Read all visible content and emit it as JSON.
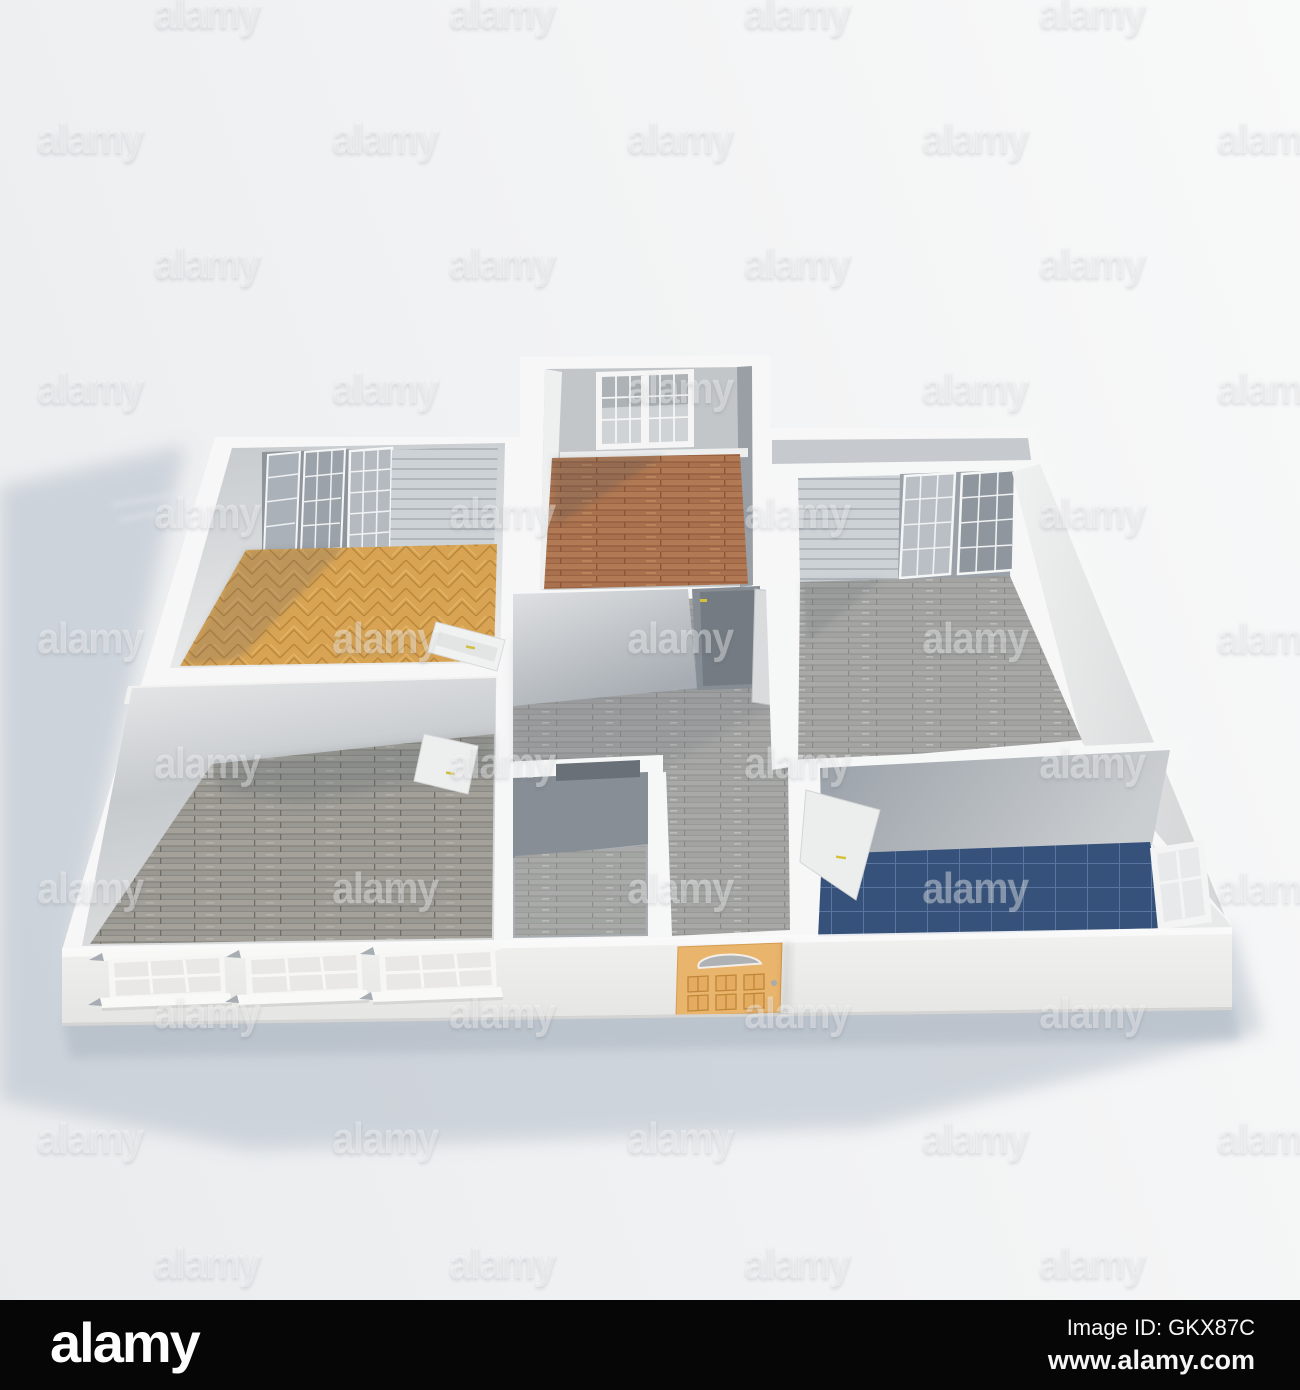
{
  "watermark": {
    "text": "alamy",
    "row_start_y": 15,
    "row_spacing": 125,
    "row_count": 11,
    "col_spacing": 295,
    "row_offsets": [
      207,
      90
    ],
    "color": "rgba(255,255,255,0.38)"
  },
  "footer": {
    "logo": "alamy",
    "image_id": "Image ID: GKX87C",
    "website": "www.alamy.com",
    "background": "#060606",
    "text_color": "#f5f5f5"
  },
  "palette": {
    "background_light": "#f8f9f9",
    "background_shade": "#e9ebed",
    "ground_shadow": "#b9c2cd",
    "wall_top": "#f7f7f8",
    "wall_face_lit": "#f1f1f0",
    "wall_face_shadow": "#c6c9cd",
    "front_wall": "#eeeeec",
    "parquet_gold": "#d8a454",
    "parquet_line": "#b9863c",
    "red_plank": "#a9714e",
    "red_plank_line": "#8a573b",
    "gray_plank": "#a3a4a2",
    "gray_plank_line": "#8f908e",
    "gray_plank_dark": "#9a9892",
    "blue_tile": "#36527a",
    "blue_grout": "#5a76a0",
    "deck": "#cdd2d6",
    "deck_line": "#a9b0b6",
    "glass": "#9aa0a6",
    "mullion": "#f5f6f6",
    "door_orange": "#e9b46c",
    "door_orange_line": "#c08638",
    "handle_yellow": "#d8c13a"
  },
  "rooms": [
    {
      "id": "living-room-top-left",
      "floor": "parquet_gold"
    },
    {
      "id": "bedroom-top-middle",
      "floor": "red_plank"
    },
    {
      "id": "bedroom-right-wing",
      "floor": "gray_plank"
    },
    {
      "id": "bedroom-bottom-left",
      "floor": "gray_plank_dark"
    },
    {
      "id": "hallway-center",
      "floor": "gray_plank"
    },
    {
      "id": "closet-center",
      "floor": "gray_plank"
    },
    {
      "id": "bathroom-right",
      "floor": "blue_tile"
    }
  ]
}
